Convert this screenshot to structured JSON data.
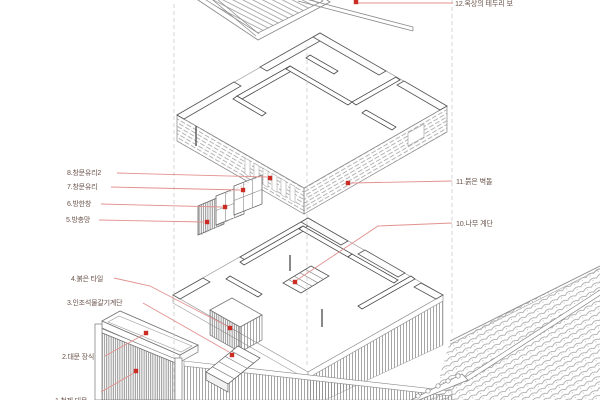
{
  "diagram": {
    "type": "exploded-axonometric-house-drawing",
    "language": "ko",
    "callouts": [
      {
        "label": "1.철제 대문"
      },
      {
        "label": "2.대문 장식"
      },
      {
        "label": "3.인조석물갈기계단"
      },
      {
        "label": "4.붉은 타일"
      },
      {
        "label": "5.방충망"
      },
      {
        "label": "6.방한창"
      },
      {
        "label": "7.창문유리"
      },
      {
        "label": "8.창문유리2"
      },
      {
        "label": "10.나무 계단"
      },
      {
        "label": "11.붉은 벽돌"
      },
      {
        "label": "12.옥상의 테두리 보"
      }
    ],
    "colors": {
      "background": "#ffffff",
      "linework": "#8a8a8a",
      "wall_line": "#4a4a4a",
      "leader_line": "#e2918e",
      "marker": "#cb2c24",
      "label_text": "#6b544c",
      "dashed_guide": "#c2c2c2"
    }
  }
}
